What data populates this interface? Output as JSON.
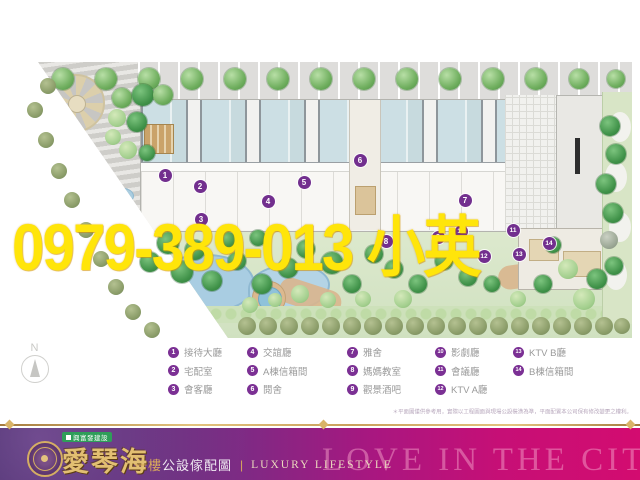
{
  "watermark": {
    "text": "0979-389-013 小英",
    "color": "#ffe50a"
  },
  "compass": {
    "label": "N"
  },
  "legend": {
    "columns": [
      [
        {
          "n": "1",
          "label": "接待大廳"
        },
        {
          "n": "2",
          "label": "宅配室"
        },
        {
          "n": "3",
          "label": "會客廳"
        }
      ],
      [
        {
          "n": "4",
          "label": "交誼廳"
        },
        {
          "n": "5",
          "label": "A棟信箱間"
        },
        {
          "n": "6",
          "label": "閱舍"
        }
      ],
      [
        {
          "n": "7",
          "label": "雅舍"
        },
        {
          "n": "8",
          "label": "媽媽教室"
        },
        {
          "n": "9",
          "label": "觀景酒吧"
        }
      ],
      [
        {
          "n": "10",
          "label": "影劇廳"
        },
        {
          "n": "11",
          "label": "會議廳"
        },
        {
          "n": "12",
          "label": "KTV A廳"
        }
      ],
      [
        {
          "n": "13",
          "label": "KTV B廳"
        },
        {
          "n": "14",
          "label": "B棟信箱間"
        }
      ]
    ]
  },
  "disclaimer": "＊平面圖僅供參考用，實際以工程圖面與現場公設裝潢為準，平面配置本公司保有修改變更之權利。",
  "footer": {
    "developer": "興富發建設",
    "brand": "愛琴海",
    "subtitle_prefix": "一樓",
    "subtitle_rest": "公設傢配圖",
    "separator": "|",
    "subtitle_en": "LUXURY LIFESTYLE",
    "bg_text": "LOVE IN THE CITY"
  },
  "colors": {
    "marker_purple": "#722f8e",
    "legend_purple": "#7b3094",
    "legend_text": "#9a9a9a",
    "watermark_yellow": "#ffe50a",
    "footer_gold": "#d8b56c",
    "footer_gradient_left": "#3a1f5d",
    "footer_gradient_right": "#d30c70",
    "tag_green": "#2f9e59",
    "unit_blue": "#ccdfe4",
    "garden_green": "#d5e3c6"
  },
  "plan": {
    "markers": [
      {
        "n": "1",
        "x": 165,
        "y": 175
      },
      {
        "n": "2",
        "x": 200,
        "y": 186
      },
      {
        "n": "3",
        "x": 201,
        "y": 219
      },
      {
        "n": "4",
        "x": 268,
        "y": 201
      },
      {
        "n": "5",
        "x": 304,
        "y": 182
      },
      {
        "n": "6",
        "x": 360,
        "y": 160
      },
      {
        "n": "7",
        "x": 465,
        "y": 200
      },
      {
        "n": "8",
        "x": 386,
        "y": 241
      },
      {
        "n": "9",
        "x": 438,
        "y": 237
      },
      {
        "n": "10",
        "x": 461,
        "y": 231
      },
      {
        "n": "11",
        "x": 513,
        "y": 230
      },
      {
        "n": "12",
        "x": 484,
        "y": 256
      },
      {
        "n": "13",
        "x": 519,
        "y": 254
      },
      {
        "n": "14",
        "x": 549,
        "y": 243
      }
    ],
    "trees": [
      [
        63,
        79,
        11,
        "t"
      ],
      [
        106,
        79,
        11,
        "t"
      ],
      [
        149,
        79,
        11,
        "t"
      ],
      [
        192,
        79,
        11,
        "t"
      ],
      [
        235,
        79,
        11,
        "t"
      ],
      [
        278,
        79,
        11,
        "t"
      ],
      [
        321,
        79,
        11,
        "t"
      ],
      [
        364,
        79,
        11,
        "t"
      ],
      [
        407,
        79,
        11,
        "t"
      ],
      [
        450,
        79,
        11,
        "t"
      ],
      [
        493,
        79,
        11,
        "t"
      ],
      [
        536,
        79,
        11,
        "t"
      ],
      [
        579,
        79,
        10,
        "t"
      ],
      [
        616,
        79,
        9,
        "t"
      ],
      [
        48,
        86,
        8,
        "o"
      ],
      [
        35,
        110,
        8,
        "o"
      ],
      [
        46,
        140,
        8,
        "o"
      ],
      [
        59,
        171,
        8,
        "o"
      ],
      [
        72,
        200,
        8,
        "o"
      ],
      [
        86,
        230,
        8,
        "o"
      ],
      [
        101,
        259,
        8,
        "o"
      ],
      [
        116,
        287,
        8,
        "o"
      ],
      [
        133,
        312,
        8,
        "o"
      ],
      [
        152,
        330,
        8,
        "o"
      ],
      [
        122,
        98,
        10,
        "t"
      ],
      [
        143,
        95,
        11,
        "d"
      ],
      [
        163,
        95,
        10,
        "t"
      ],
      [
        117,
        118,
        9,
        "l"
      ],
      [
        137,
        122,
        10,
        "d"
      ],
      [
        113,
        137,
        8,
        "l"
      ],
      [
        128,
        150,
        9,
        "l"
      ],
      [
        147,
        153,
        8,
        "d"
      ],
      [
        610,
        126,
        10,
        "d"
      ],
      [
        616,
        154,
        10,
        "d"
      ],
      [
        606,
        184,
        10,
        "d"
      ],
      [
        613,
        213,
        10,
        "d"
      ],
      [
        609,
        240,
        9,
        "g"
      ],
      [
        614,
        266,
        9,
        "d"
      ],
      [
        168,
        243,
        11,
        "d"
      ],
      [
        195,
        250,
        10,
        "d"
      ],
      [
        150,
        262,
        10,
        "d"
      ],
      [
        182,
        272,
        11,
        "d"
      ],
      [
        212,
        281,
        10,
        "d"
      ],
      [
        237,
        261,
        9,
        "d"
      ],
      [
        228,
        240,
        8,
        "d"
      ],
      [
        258,
        238,
        8,
        "d"
      ],
      [
        262,
        284,
        10,
        "d"
      ],
      [
        288,
        268,
        10,
        "d"
      ],
      [
        306,
        249,
        9,
        "d"
      ],
      [
        332,
        263,
        11,
        "d"
      ],
      [
        352,
        284,
        9,
        "d"
      ],
      [
        300,
        294,
        9,
        "l"
      ],
      [
        328,
        300,
        8,
        "l"
      ],
      [
        374,
        254,
        9,
        "d"
      ],
      [
        394,
        269,
        9,
        "d"
      ],
      [
        418,
        284,
        9,
        "d"
      ],
      [
        444,
        261,
        9,
        "d"
      ],
      [
        468,
        277,
        9,
        "d"
      ],
      [
        492,
        284,
        8,
        "d"
      ],
      [
        518,
        299,
        8,
        "l"
      ],
      [
        543,
        284,
        9,
        "d"
      ],
      [
        568,
        269,
        10,
        "l"
      ],
      [
        597,
        279,
        10,
        "d"
      ],
      [
        553,
        245,
        8,
        "d"
      ],
      [
        584,
        299,
        11,
        "l"
      ],
      [
        363,
        299,
        8,
        "l"
      ],
      [
        403,
        299,
        9,
        "l"
      ],
      [
        250,
        305,
        8,
        "l"
      ],
      [
        275,
        300,
        7,
        "l"
      ],
      [
        247,
        326,
        9,
        "o"
      ],
      [
        268,
        326,
        9,
        "o"
      ],
      [
        289,
        326,
        9,
        "o"
      ],
      [
        310,
        326,
        9,
        "o"
      ],
      [
        331,
        326,
        9,
        "o"
      ],
      [
        352,
        326,
        9,
        "o"
      ],
      [
        373,
        326,
        9,
        "o"
      ],
      [
        394,
        326,
        9,
        "o"
      ],
      [
        415,
        326,
        9,
        "o"
      ],
      [
        436,
        326,
        9,
        "o"
      ],
      [
        457,
        326,
        9,
        "o"
      ],
      [
        478,
        326,
        9,
        "o"
      ],
      [
        499,
        326,
        9,
        "o"
      ],
      [
        520,
        326,
        9,
        "o"
      ],
      [
        541,
        326,
        9,
        "o"
      ],
      [
        562,
        326,
        9,
        "o"
      ],
      [
        583,
        326,
        9,
        "o"
      ],
      [
        604,
        326,
        9,
        "o"
      ],
      [
        622,
        326,
        8,
        "o"
      ]
    ]
  }
}
